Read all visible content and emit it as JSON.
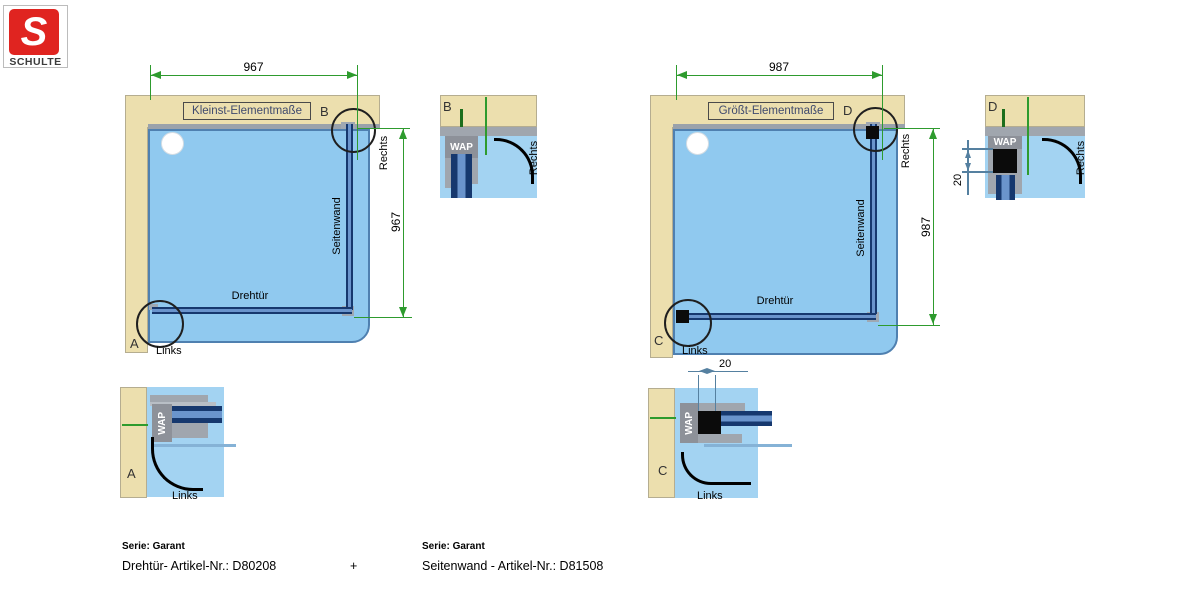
{
  "logo": {
    "letter": "S",
    "name": "SCHULTE"
  },
  "shared": {
    "wap": "WAP",
    "links": "Links",
    "rechts": "Rechts",
    "door": "Drehtür",
    "sidewall": "Seitenwand"
  },
  "small": {
    "title": "Kleinst-Elementmaße",
    "width": "967",
    "height": "967",
    "top_marker": "B",
    "bottom_marker": "A"
  },
  "large": {
    "title": "Größt-Elementmaße",
    "width": "987",
    "height": "987",
    "top_marker": "D",
    "bottom_marker": "C",
    "gap": "20"
  },
  "details": {
    "a": "A",
    "b": "B",
    "c": "C",
    "d": "D"
  },
  "footer": {
    "series_left": "Serie: Garant",
    "article_left": "Drehtür- Artikel-Nr.: D80208",
    "plus": "+",
    "series_right": "Serie: Garant",
    "article_right": "Seitenwand - Artikel-Nr.: D81508"
  },
  "colors": {
    "wall": "#ecdfae",
    "tray": "#90c9ef",
    "tray_border": "#4f80b0",
    "profile_dark": "#16386e",
    "dim_green": "#2e9b2e",
    "dim_blue": "#5580a0",
    "logo_red": "#e02420"
  }
}
